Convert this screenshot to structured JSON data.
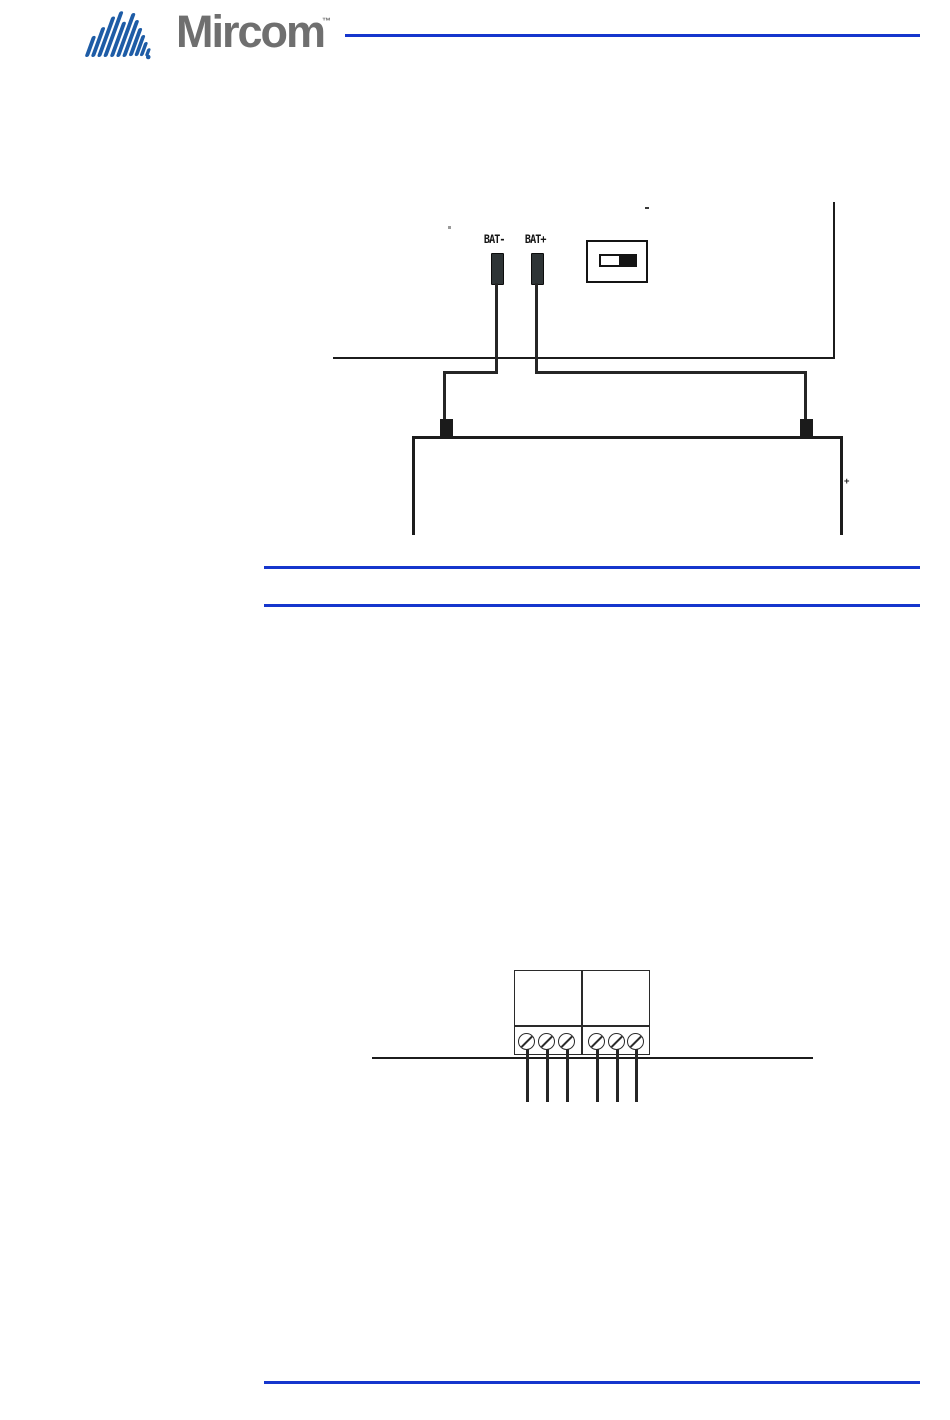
{
  "page": {
    "background_color": "#ffffff",
    "diagram_line_color": "#1c1c1c",
    "accent_blue": "#1636cd"
  },
  "header": {
    "brand": "Mircom",
    "trademark": "™",
    "logo_stripe_color": "#1e5ca6",
    "brand_text_color": "#6f6f6f"
  },
  "figures": {
    "battery_wiring": {
      "terminal_labels": {
        "negative": "BAT-",
        "positive": "BAT+"
      },
      "battery_plus_mark": "+",
      "switch_state": "right",
      "wire_color": "#262626"
    },
    "terminal_block": {
      "screw_count": 6,
      "compartments": 2
    }
  }
}
